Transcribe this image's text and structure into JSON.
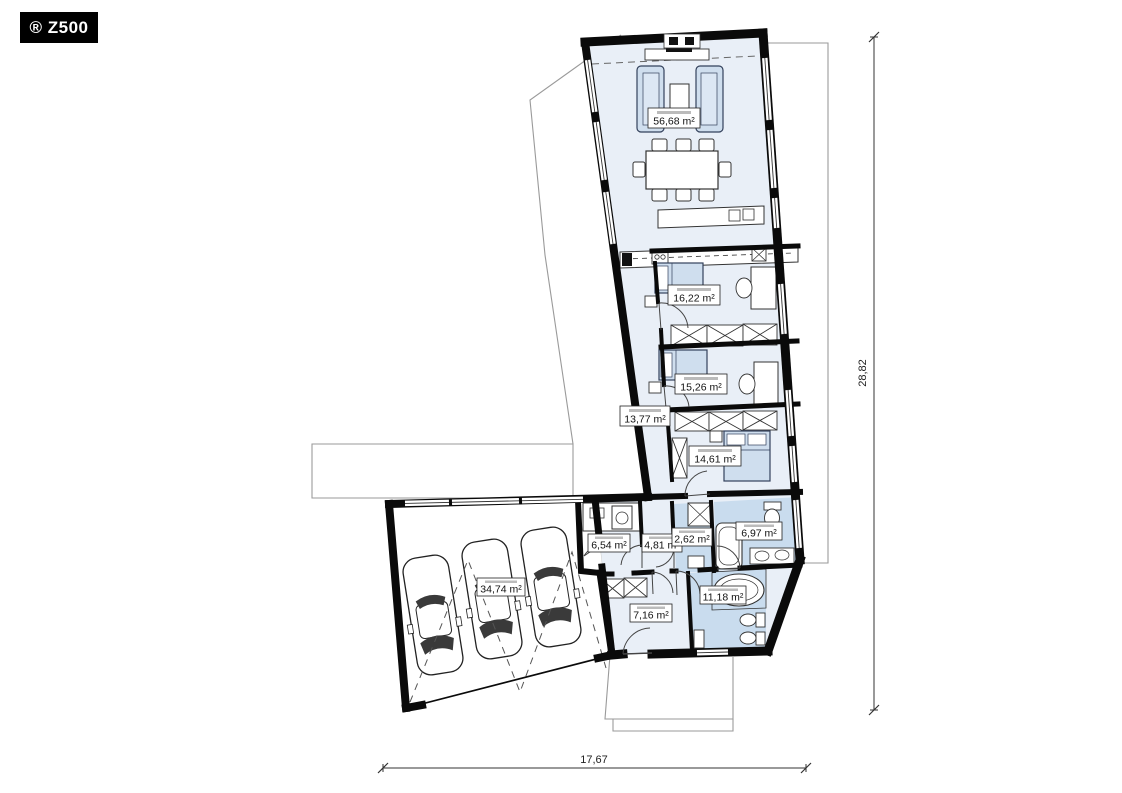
{
  "logo": {
    "text": "® Z500"
  },
  "rooms": {
    "living_dining": {
      "area": "56,68 m²"
    },
    "bedroom1": {
      "area": "16,22 m²"
    },
    "bedroom2": {
      "area": "15,26 m²"
    },
    "hallway": {
      "area": "13,77 m²"
    },
    "bedroom3": {
      "area": "14,61 m²"
    },
    "utility": {
      "area": "6,54 m²"
    },
    "hall": {
      "area": "4,81 m²"
    },
    "wc": {
      "area": "2,62 m²"
    },
    "bathroom1": {
      "area": "6,97 m²"
    },
    "entry": {
      "area": "7,16 m²"
    },
    "bathroom2": {
      "area": "11,18 m²"
    },
    "garage": {
      "area": "34,74 m²"
    }
  },
  "dimensions": {
    "total_width": "17,67",
    "total_height": "28,82"
  },
  "colors": {
    "wall": "#0a0a0a",
    "room_fill": "#e9eff7",
    "wet_room_fill": "#c9dcee",
    "furniture_fill": "#cfdeee",
    "terrain_line": "#9a9a9a"
  }
}
